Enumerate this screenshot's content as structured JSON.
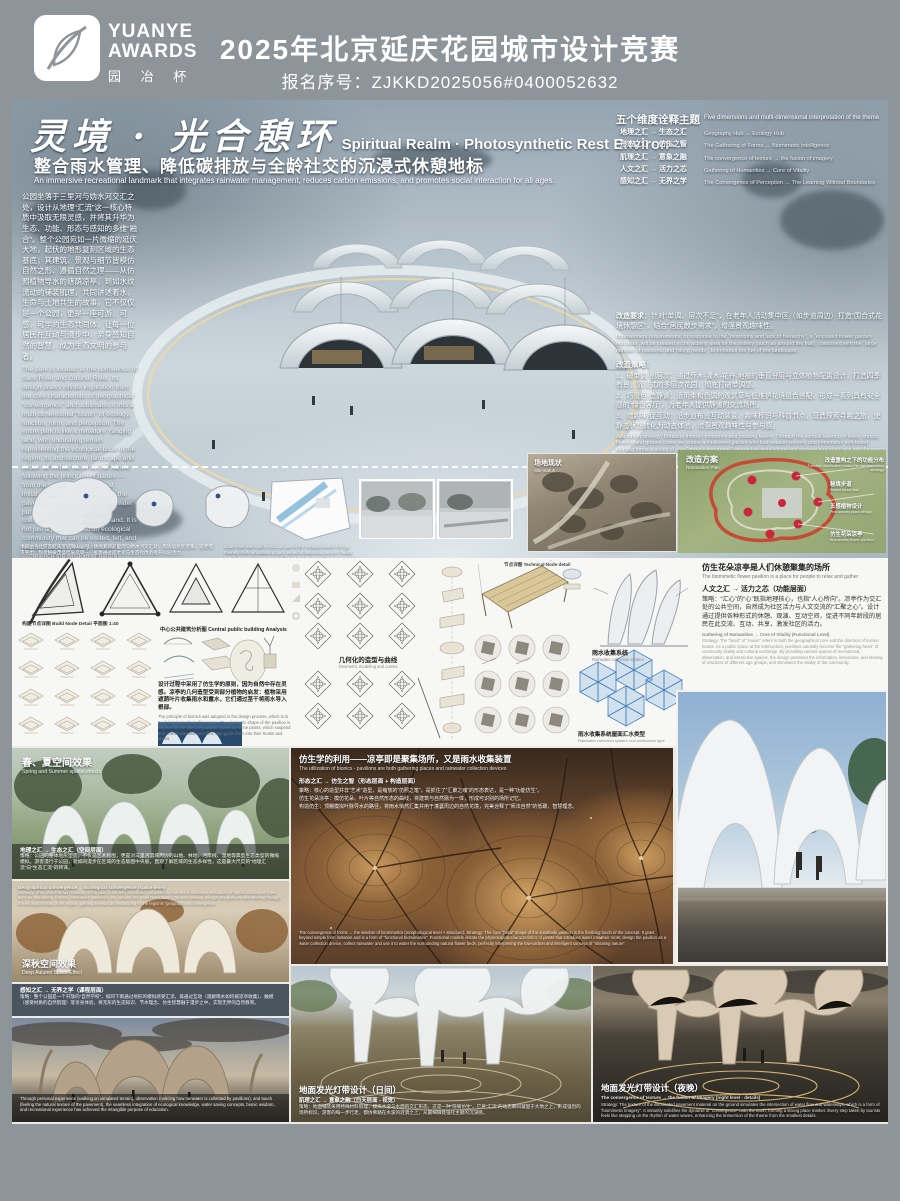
{
  "colors": {
    "header_bg": "#8d949a",
    "accent_warm": "#e8c47a",
    "plan_red": "#c9283c",
    "water_blue": "#7ab3d4",
    "panel_white": "#f7f7f5"
  },
  "header": {
    "brand_line1": "YUANYE",
    "brand_line2": "AWARDS",
    "brand_cn": "园 冶 杯",
    "title": "2025年北京延庆花园城市设计竞赛",
    "reg_no": "报名序号：ZJKKD2025056#0400052632"
  },
  "hero": {
    "title_cn": "灵境 · 光合憩环",
    "title_en": "Spiritual Realm · Photosynthetic Rest Environ-",
    "subtitle_cn": "整合雨水管理、降低碳排放与全龄社交的沉浸式休憩地标",
    "subtitle_en": "An immersive recreational landmark that integrates rainwater management, reduces carbon emissions, and promotes social interaction for all ages.",
    "intro_cn": "公园坐落于三里河与妫水河交汇之处，设计从地理“汇流”这一核心特质中汲取无限灵感，并将其升华为生态、功能、形态与感知的多维“融合”。整个公园宛如一片微缩的延庆大地，起伏的地形复刻区域的生态基底；其建筑、景观与细节皆模仿自然之形、遵循自然之理——从仿照植物导水的遮荫凉亭，到如水纹流动的铺装肌理，共同讲述着水、生命与土地共生的故事。它不仅仅是一个公园，更是一座可游、可感、可学的生态共同体，让每一位居民在互动与漫步中，亲身感知自然的智慧，成为生态文明的参与者。",
    "intro_en": "The park is located at the confluence of Sanli River and Guishui River. Its design draws infinite inspiration from the core characteristic of geographical “convergence” and sublimates it into a multi-dimensional “fusion” of ecology, function, form, and perception. The entire park is like a miniature Yanqing land, with undulating terrain representing the ecological base of the region. Its architecture, landscape and details all imitate the shape of nature, following the principles of nature — from the sunshade pavilion that imitates plants to guide water, to the pavement texture that flows like water patterns, telling the story of the coexistence of water, life, and land. It is not just a park, but also an ecological community that can be visited, felt, and learned, allowing every resident to experience the wisdom of nature firsthand through interaction and walking, and become a participant in ecological civilization.",
    "dimensions": {
      "title_cn": "五个维度诠释主题",
      "title_en": "Five dimensions and multi-dimensional interpretation of the theme",
      "items": [
        {
          "cn": "地理之汇 → 生态之汇",
          "en": "Geography Hub → Ecology Hub"
        },
        {
          "cn": "形态之汇 → 仿生之智",
          "en": "The Gathering of Forms → Biomimetic Intelligence"
        },
        {
          "cn": "肌理之汇 → 意象之融",
          "en": "The convergence of texture → the fusion of imagery"
        },
        {
          "cn": "人文之汇 → 活力之芯",
          "en": "Gathering of Humanities → Core of Vitality"
        },
        {
          "cn": "感知之汇 → 无界之学",
          "en": "The Convergence of Perception → The Learning Without Boundaries"
        }
      ]
    },
    "requirements": {
      "req_head_cn": "改造要求：",
      "req_cn": "针对“单调、层次不足”，在老年人活动集中区（如步道周边）打造“围合式花境休憩区”，结合“居民散步需求”，增强景观趣味性。",
      "req_head_en": "Improvement requirements:",
      "req_en": "In response to the “monotony and lack of hierarchy”, a “enclosed flower garden rest area” will be created in the activity area for the elderly (such as around the trail), combined with the “large number of residents and hiking needs”, to enhance the fun of the landscape.",
      "strategy_head": "改造策略：",
      "s1": "1、破单调·创层次：通过乔木-灌木-花卉-地被的垂直分层与立体植物配置设计，打造四季有景、沉浸式的多层次花园，彻底打破单调感。",
      "s2": "2、巧设色·造静谧：运用柔和色调的观赏草与低维护花境组合搭配，形成一系列具有安全感的“绿色客厅”，为老年人提供静谧的交流场所。",
      "s3": "3、增趣味·促互动：沿步道布设互动装置、趣味标识与科普节点，营造探索寻趣之旅，使静态休憩转化为动态体验，增强景观趣味性与参与感。",
      "strategy_en": "Adaptation strategy: Breaking through monotony and creating layers: Through the vertical layering of trees, shrubs, flowers, and ground cover, we create a multi-level garden with four-season scenery and immersion; soft-toned planting forms a series of safe “green living rooms”; interactive installations and signage turn static rest into dynamic experience, and enhance the participation and fun of the landscape."
    },
    "maps_caption_cn": "项目位于北京市延庆区冠帽山公园，场地紧邻三里河与妫水河交汇处，周边居民区密集、适老需求突出；现状植被茂盛但层次单一，亟需通过适老化与生态化改造提升公园活力。",
    "maps_caption_en": "Guan Park was built in 2015 as part of the Yanqing District All Age Friendly Park renovation project, aimed at improving seniors' health needs, enhancing the quality of life for residents, and providing a place for leisure entertainment; the renovation of parks helps to improve urban functions, increase the green area of the city, improve the urban ecological environment, and enhance the overall image of the city."
  },
  "site": {
    "existing_cn": "场地现状",
    "existing_en": "Site status",
    "plan_cn": "改造方案",
    "plan_en": "Renovation Plan",
    "annotations": [
      {
        "cn": "改造重构之下的功能分布",
        "en": "Function distribution under the transformation strategy"
      },
      {
        "cn": "秘境步道",
        "en": "Secret forest trail"
      },
      {
        "cn": "五感植物设计",
        "en": "Five senses plant design"
      },
      {
        "cn": "仿生花朵凉亭",
        "en": "Biomimetic flower pavilion"
      }
    ]
  },
  "analysis": {
    "node_detail": "构建节点详图  Build Node Detail 平面图 1:40",
    "central": "中心公共建筑分析图 Central public building Analysis",
    "geometry_cn": "几何化的造型与曲线",
    "geometry_en": "Geometric modeling and curves",
    "tech_node": "节点详图 Technical Node detail",
    "bionics_cn": "设计过程中采用了仿生学的原则，因为自然中存在灵感。凉亭的几何造型受到部分植物的启发：植物采用遮荫叶片收集雨水和露水，它们通过茎干将雨水导入根部。",
    "bionics_en": "The principle of bionics was adopted in the design process, which is to seek inspiration from this nature. The geometric shape of the pavilion is inspired by the use of hypostatic leaves by some plants, which suspend and collect rainwater and dew, and guide them into their trunks and stems.",
    "rain_cn": "雨水收集系统",
    "rain_en": "Rainwater collection system",
    "roof_cn": "雨水收集系统屋面汇水类型",
    "roof_en": "Rainwater collection system roof confluence type"
  },
  "pavilion": {
    "title_cn": "仿生花朵凉亭是人们休憩聚集的场所",
    "title_en": "The biomimetic flower pavilion is a place for people to relax and gather",
    "line": "人文之汇 → 活力之芯（功能层面）",
    "strategy_cn": "策略：“汇心”的“心”既指地理核心，也指“人心所向”。凉亭作为交汇处的公共空间，自然成为社区活力与人文交流的“汇聚之心”。设计通过提供各种形式的休憩、观演、互动空间，促进不同年龄段的居民在此交流、互动、共享，激发社区的活力。",
    "en_head": "Gathering of Humanities → Core of Vitality (Functional Level)",
    "strategy_en": "Strategy: The “heart” of “Huixin” refers to both the geographical core and the direction of human hearts. As a public space at the intersection, pavilions naturally become the “gathering heart” of community vitality and cultural exchange. By providing various spaces of recreational, observation, and interactive spaces, the design promotes the information, interaction, and sharing of residents of different age groups, and stimulates the vitality of the community."
  },
  "renders": {
    "spring": {
      "label_cn": "春、夏空间效果",
      "label_en": "Spring and Summer spatial effects",
      "head": "地理之汇 → 生态之汇（空间层面）",
      "body": "策略：公园的整体地形塑造，不仅是艺术构图，更是对三里河流域周边的山地、林地、河岸线、湿地等典型生态类型的微缩模拟。游客漫行于公园，就如同漫步在区域的生态版图中央般，直观了解区域的生态多样性，这是最大尺度的“地理汇流”向“生态汇流”的转译。"
    },
    "autumn": {
      "en_head": "Geographical convergence → Ecological convergence (space level)",
      "en_body": "Strategy: The overall terrain shaping of the park is not only an artistic composition, but also a miniature simulation of typical ecological types such as mountains, forests, riverbanks, wetlands, etc. around the Sanli River Basin. Tourists walking through the park are like strolling through the ecological map of the region, gaining a visual understanding of the region's “geographical convergence”.",
      "label_cn": "深秋空间效果",
      "label_en": "Deep Autumn Space Effect"
    },
    "perception": {
      "head": "感知之汇 → 无界之学（课程层面）",
      "body": "策略：整个公园是一个开放的“自然学校”，如同下雨通过地形的模拟感受汇流，再通过互动（观察雨水如何被凉亭收集）、触摸（感受材质的自然肌理）等亲身体验，将无形的生态知识、节水理念、仿生智慧融于漫步之中，实现无界的自然教育。"
    },
    "dusk_en": "Through personal experience (walking on simulated terrain), observation (noticing how rainwater is collected by pavilions), and touch (feeling the natural texture of the pavement), the seamless integration of ecological knowledge, water saving concepts, bionic wisdom, and recreational experience has achieved the intangible purpose of education.",
    "bionics_use": {
      "title_cn": "仿生学的利用——凉亭即是聚集场所，又是雨水收集装置",
      "title_en": "The utilization of bionics - pavilions are both gathering places and rainwater collection devices",
      "line1": "形态之汇 → 仿生之智（形态层面 + 构造层面）",
      "line2": "策略：核心的造型并非“艺术”造型，是缩放的“仿照之笔”，是抓住了“汇聚之魂”的形态表达，是一种“功能仿生”。",
      "line3": "仿生花朵凉亭：模仿花朵、叶片等自然形态的曲线，将建筑与自然融为一体，形成可识别的场所记忆。",
      "line4": "构造仿生：顶棚模拟叶脉导水的路径，将雨水悄然汇集并用于灌溉周边的自然花境，完美诠释了“师法自然”的低碳、智慧理念。",
      "en": "The convergence of forms → the wisdom of biomimetics (morphological level + structure). Strategy: The core “petal” shape of the sunshade pavilion is the finishing touch of the concept. It goes beyond simple form imitation and is a form of “functional biomimetics”. Functional models imitate the physiological characteristics of plants that introduce water into their roots; design the pavilion as a water collection device, collect rainwater and use it to water the surrounding natural flower beds, perfectly interpreting the low-carbon and intelligent concept of “imitating nature”."
    },
    "daytime": {
      "label": "地面发光灯带设计（日间）",
      "line": "肌理之汇 → 意象之融（白天层面 - 视觉）",
      "body": "策略：地面铺装采用特殊材料肌理，模拟水波与水面的交汇形态，这是一种“隐喻仿生”，它将“汇流”的动态瞬间凝固于大地之上，形成强烈的场所标识。游客的每一步行走，都仿佛踏在水波的涟漪之上，从最细微处强化主题的沉浸感。"
    },
    "night": {
      "label": "地面发光灯带设计（夜晚）",
      "en_head": "The convergence of texture → the fusion of imagery (night level - details)",
      "en_body": "Strategy: The texture of the illuminated pavement material on the ground simulates the intersection of water flow and waterways, which is a form of “biomimetic imagery”. It instantly solidifies the dynamic of “convergence” onto the earth, forming a strong place marker. Every step taken by tourists feels like stepping on the rhythm of water waves, enhancing the immersion of the theme from the smallest details."
    }
  }
}
